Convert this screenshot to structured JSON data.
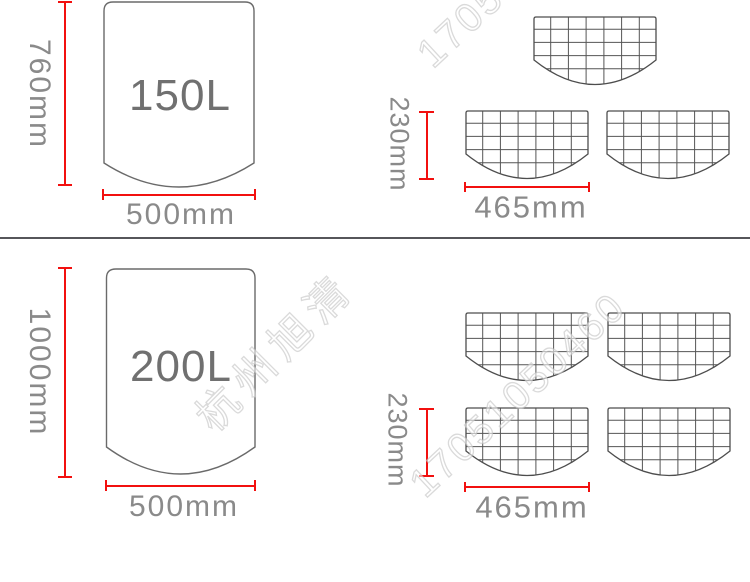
{
  "top_section": {
    "barrel": {
      "label": "150L",
      "height_label": "760mm",
      "width_label": "500mm"
    },
    "mesh": {
      "count": 3,
      "height_label": "230mm",
      "width_label": "465mm"
    }
  },
  "bottom_section": {
    "barrel": {
      "label": "200L",
      "height_label": "1000mm",
      "width_label": "500mm"
    },
    "mesh": {
      "count": 4,
      "height_label": "230mm",
      "width_label": "465mm"
    }
  },
  "watermarks": {
    "phone": "17051050460",
    "brand": "杭州旭清"
  },
  "colors": {
    "dimension_red": "#f2100f",
    "label_gray": "#8a8a8a",
    "volume_gray": "#707070",
    "outline_gray": "#6a6a6a",
    "mesh_line_gray": "#555555",
    "divider_gray": "#56565a",
    "background": "#ffffff"
  }
}
